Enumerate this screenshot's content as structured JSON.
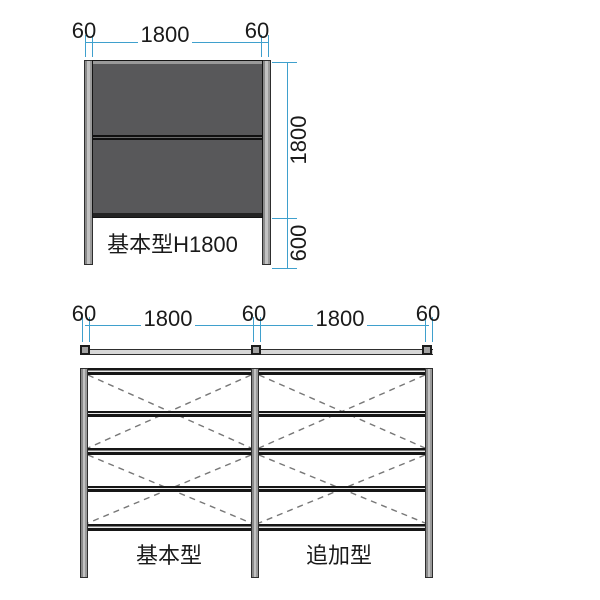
{
  "front_view": {
    "dims_top": [
      "60",
      "1800",
      "60"
    ],
    "height_label": "1800",
    "embed_label": "600",
    "caption": "基本型H1800"
  },
  "plan_view": {
    "dims": [
      "60",
      "1800",
      "60",
      "1800",
      "60"
    ]
  },
  "elevation_view": {
    "captions": [
      "基本型",
      "追加型"
    ]
  },
  "colors": {
    "dimension_blue": "#3fa0cd",
    "panel_gray": "#58585a",
    "post_gray": "#b3b3b3",
    "line_black": "#1a1a1a",
    "brace_gray": "#777777",
    "background": "#ffffff"
  }
}
